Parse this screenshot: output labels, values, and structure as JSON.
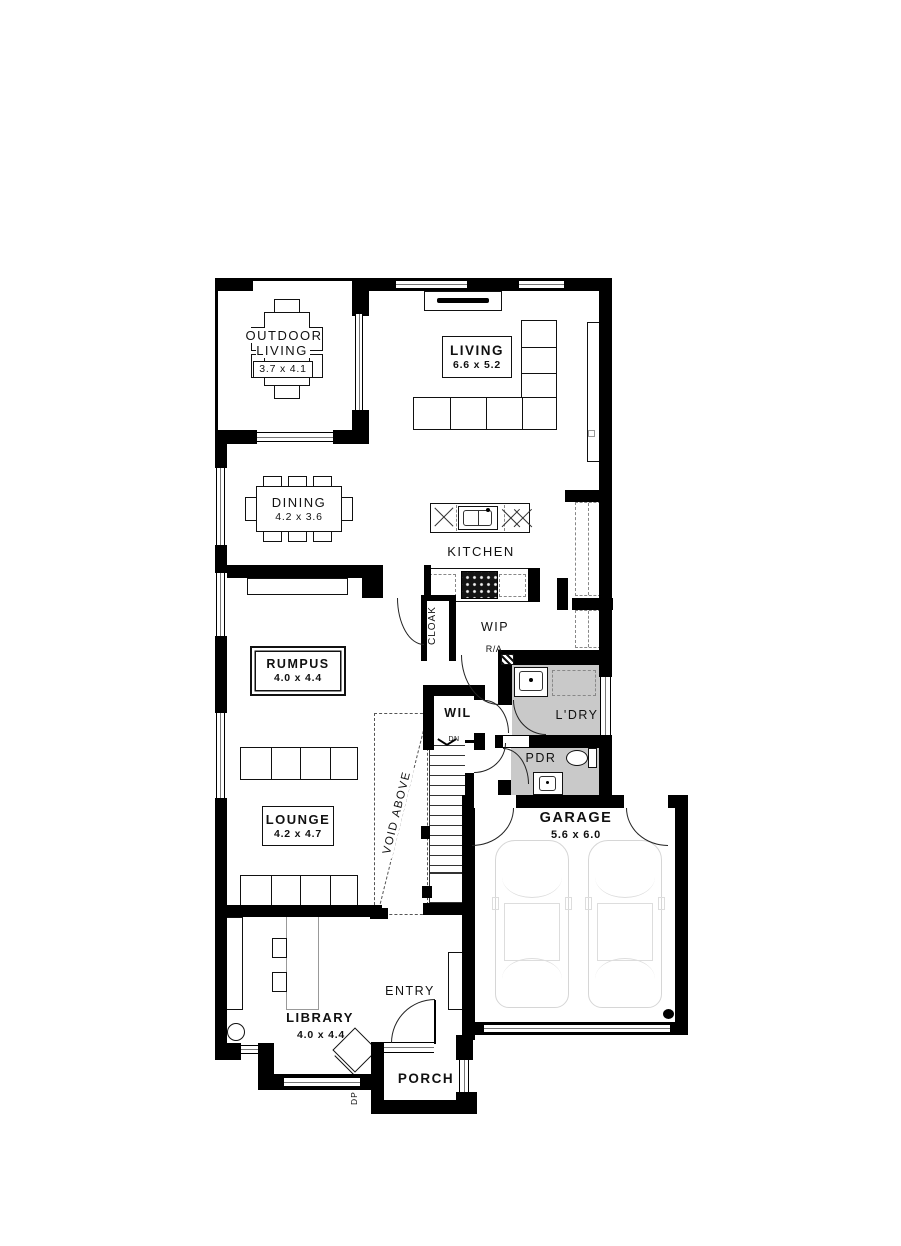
{
  "plan": {
    "rooms": {
      "outdoor_living": {
        "name": "OUTDOOR LIVING",
        "dims": "3.7 x 4.1"
      },
      "living": {
        "name": "LIVING",
        "dims": "6.6 x 5.2"
      },
      "dining": {
        "name": "DINING",
        "dims": "4.2 x 3.6"
      },
      "kitchen": {
        "name": "KITCHEN"
      },
      "cloak": {
        "name": "CLOAK"
      },
      "wip": {
        "name": "WIP"
      },
      "rumpus": {
        "name": "RUMPUS",
        "dims": "4.0 x 4.4"
      },
      "wil": {
        "name": "WIL"
      },
      "laundry": {
        "name": "L'DRY"
      },
      "powder": {
        "name": "PDR"
      },
      "lounge": {
        "name": "LOUNGE",
        "dims": "4.2 x 4.7"
      },
      "garage": {
        "name": "GARAGE",
        "dims": "5.6 x 6.0"
      },
      "library": {
        "name": "LIBRARY",
        "dims": "4.0 x 4.4"
      },
      "entry": {
        "name": "ENTRY"
      },
      "porch": {
        "name": "PORCH"
      }
    },
    "annotations": {
      "void": "VOID ABOVE",
      "down": "DN",
      "return_air": "R/A",
      "downpipe": "DP"
    },
    "colors": {
      "wall": "#000000",
      "tile": "#c9c9c9",
      "car_outline": "#d9d9d9"
    }
  }
}
